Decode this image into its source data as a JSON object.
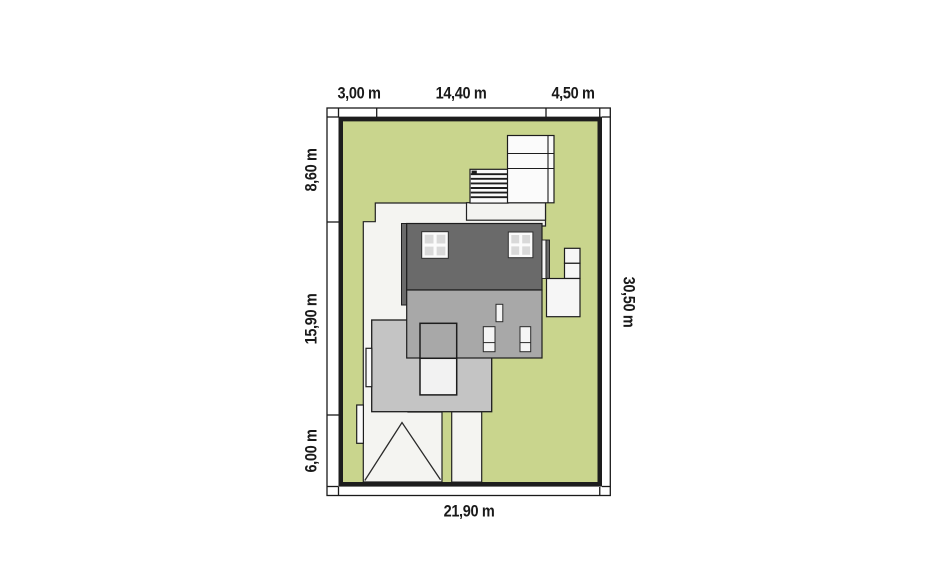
{
  "dimensions": {
    "top": [
      "3,00 m",
      "14,40 m",
      "4,50 m"
    ],
    "left": [
      "8,60 m",
      "15,90 m",
      "6,00 m"
    ],
    "right": "30,50 m",
    "bottom": "21,90 m"
  },
  "colors": {
    "plot_green": "#c9d58d",
    "roof_dark": "#6a6a6a",
    "roof_medium": "#a8a8a8",
    "roof_light": "#c4c4c4",
    "paving": "#f4f4f1",
    "outline": "#1d1d1d"
  }
}
